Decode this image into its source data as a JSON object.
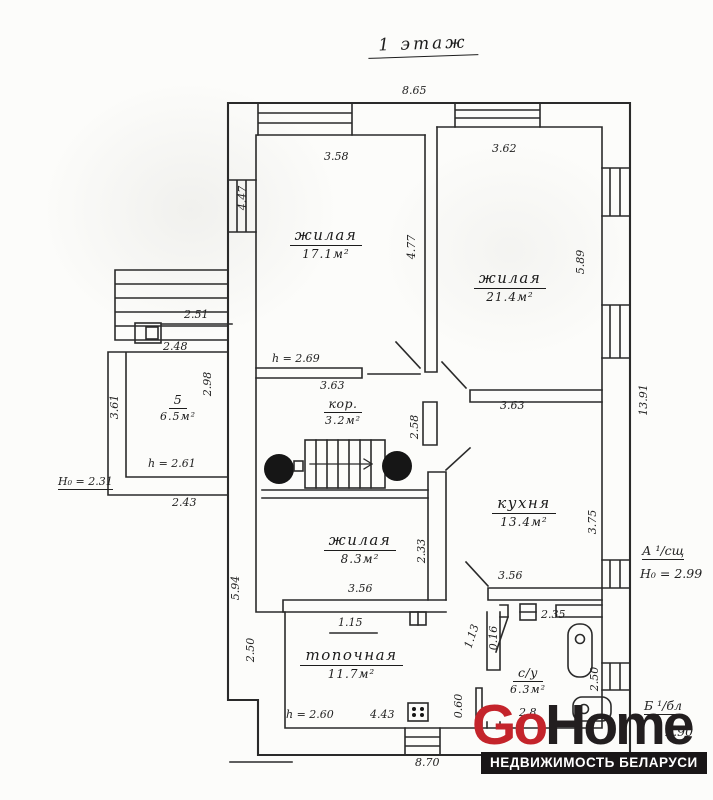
{
  "title": "1 этаж",
  "rooms": {
    "living1": {
      "name": "жилая",
      "area": "17.1м²"
    },
    "living2": {
      "name": "жилая",
      "area": "21.4м²"
    },
    "corridor": {
      "name": "кор.",
      "area": "3.2м²"
    },
    "room5": {
      "name": "5",
      "area": "6.5м²"
    },
    "kitchen": {
      "name": "кухня",
      "area": "13.4м²"
    },
    "living3": {
      "name": "жилая",
      "area": "8.3м²"
    },
    "boiler": {
      "name": "топочная",
      "area": "11.7м²"
    },
    "sanitary": {
      "name": "с/у",
      "area": "6.3м²"
    }
  },
  "dims": {
    "top_total": "8.65",
    "top_left_room": "3.58",
    "top_right_room": "3.62",
    "left_wall_upper": "4.47",
    "living_divider": "4.77",
    "right_upper": "5.89",
    "right_total": "13.91",
    "annex_top": "2.51",
    "annex_inner": "2.48",
    "annex_right": "2.98",
    "annex_left": "3.61",
    "annex_bottom": "2.43",
    "corridor_top": "3.63",
    "corridor_right": "3.63",
    "corridor_stub": "2.58",
    "left_wall_lower": "5.94",
    "living3_right": "2.33",
    "living3_bottom": "3.56",
    "kitchen_right": "3.75",
    "kitchen_bottom": "3.56",
    "boiler_top": "1.15",
    "boiler_left": "2.50",
    "boiler_bottom": "4.43",
    "bath_door": "2.35",
    "bath_right": "2.50",
    "bath_bottom": "2.8",
    "door_width": "0.60",
    "door_a": "1.13",
    "door_b": "0.16",
    "bottom_total": "8.70"
  },
  "notes": {
    "ceiling_269": "h = 2.69",
    "ceiling_261": "h = 2.61",
    "ceiling_260": "h = 2.60",
    "height_231": "H₀ = 2.31",
    "section_a_label": "А ¹/сщ",
    "section_a_height": "H₀ = 2.99",
    "section_b_label": "Б ¹/бл",
    "section_b_height": "– 2.90"
  },
  "logo": {
    "part1": "Go",
    "part2": "Home",
    "tagline": "НЕДВИЖИМОСТЬ БЕЛАРУСИ",
    "accent_color": "#c4242b",
    "dark_color": "#221e1f"
  }
}
